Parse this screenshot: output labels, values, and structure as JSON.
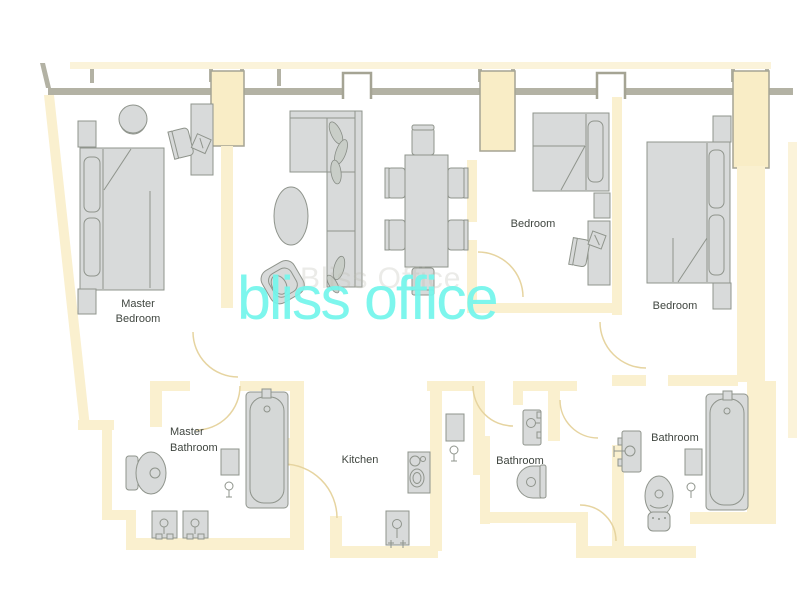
{
  "watermark": {
    "text": "bliss office",
    "ghost_text": "Bliss Office",
    "color": "#74F6EC"
  },
  "rooms": {
    "master_bedroom": {
      "line1": "Master",
      "line2": "Bedroom"
    },
    "bedroom_middle": {
      "label": "Bedroom"
    },
    "bedroom_right": {
      "label": "Bedroom"
    },
    "master_bathroom": {
      "line1": "Master",
      "line2": "Bathroom"
    },
    "kitchen": {
      "label": "Kitchen"
    },
    "bathroom_middle": {
      "label": "Bathroom"
    },
    "bathroom_right": {
      "label": "Bathroom"
    }
  },
  "palette": {
    "wall_fill": "#FAF0CF",
    "structure_gray": "#B3B2A4",
    "furniture_fill": "#D8DADA",
    "furniture_stroke": "#8F948C",
    "door_arc": "#E6D4A0",
    "label_color": "#3F453F"
  },
  "furniture_icons": [
    "double-bed-icon",
    "single-bed-icon",
    "nightstand-icon",
    "desk-icon",
    "desk-chair-icon",
    "round-chair-icon",
    "l-sofa-icon",
    "potted-plant-icon",
    "oval-rug-icon",
    "lounge-chair-icon",
    "dining-table-icon",
    "dining-chair-icon",
    "toilet-icon",
    "sink-vanity-icon",
    "bathtub-icon",
    "stove-icon",
    "kitchen-sink-icon",
    "cabinet-icon",
    "shower-head-icon",
    "window-icon",
    "door-arc-icon"
  ]
}
